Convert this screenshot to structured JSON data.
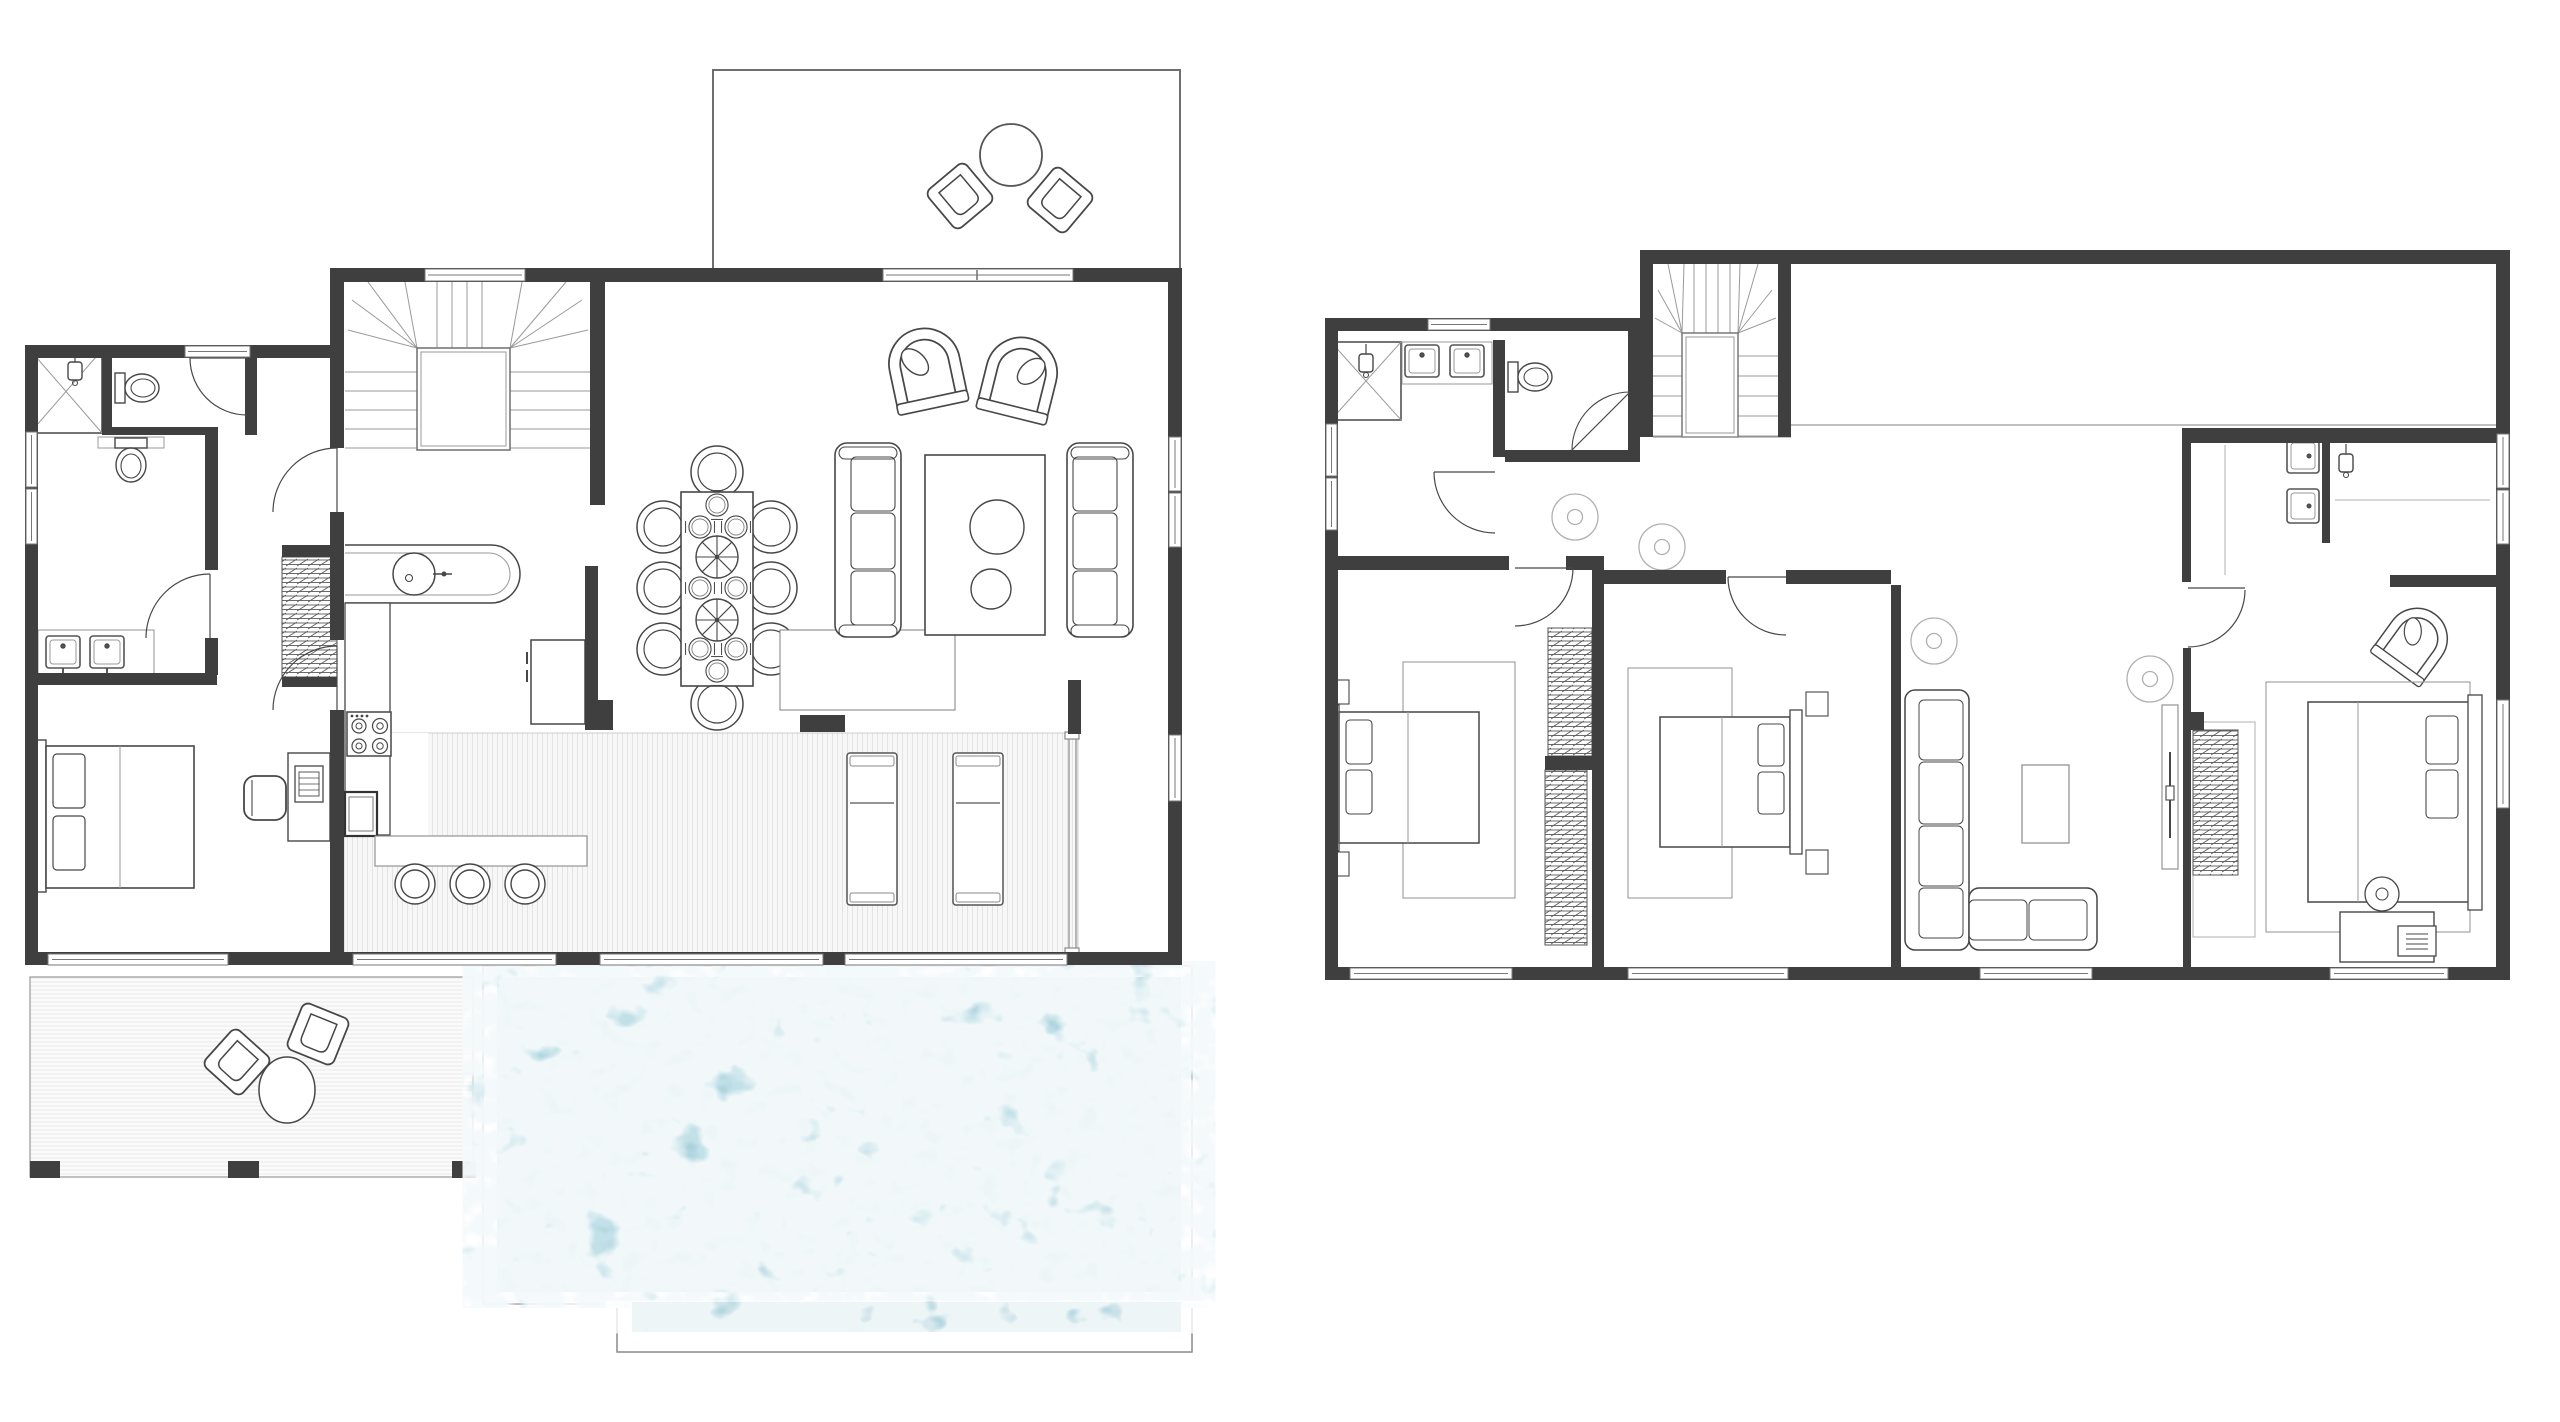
{
  "image_type": "architectural-floor-plan",
  "canvas": {
    "width": 2560,
    "height": 1422,
    "background": "#ffffff"
  },
  "colors": {
    "wall": "#3f3f3f",
    "furniture_line": "#474747",
    "light_line": "#8a8a8a",
    "faint_line": "#b0b0b0",
    "deck_stripe": "#e4e4e4",
    "water_base": "#a7cfda",
    "water_caustic": "#ffffff",
    "paper": "#ffffff"
  },
  "plans": [
    {
      "label": "ground-floor-plan",
      "position": "left",
      "areas": [
        "entry-terrace",
        "staircase",
        "shower-room",
        "wc",
        "bathroom",
        "bedroom",
        "kitchen",
        "dining-area",
        "living-area",
        "covered-deck",
        "lower-deck",
        "swimming-pool"
      ],
      "fixtures": [
        "round-outdoor-table",
        "outdoor-chairs",
        "shower",
        "toilets",
        "double-vanity",
        "wardrobe",
        "double-bed",
        "desk-and-chair",
        "kitchen-counter",
        "sink",
        "cooktop",
        "oven",
        "fridge",
        "breakfast-bar",
        "bar-stools",
        "dining-table",
        "dining-chairs",
        "place-settings",
        "lazy-susans",
        "sideboard",
        "sofas",
        "coffee-table",
        "arch-lounge-chairs",
        "sun-loungers",
        "pool-water"
      ]
    },
    {
      "label": "upper-floor-plan",
      "position": "right",
      "areas": [
        "staircase",
        "void",
        "hallway",
        "shower-room",
        "wc",
        "bedroom-2",
        "bedroom-3",
        "lounge",
        "master-bedroom",
        "master-bathroom"
      ],
      "fixtures": [
        "shower",
        "double-sinks",
        "toilet",
        "ceiling-fans",
        "wardrobes",
        "double-beds",
        "rugs",
        "l-shaped-sofa",
        "coffee-table",
        "tv-console",
        "armchair",
        "desk-with-lamp",
        "master-shower",
        "master-sinks"
      ]
    }
  ]
}
